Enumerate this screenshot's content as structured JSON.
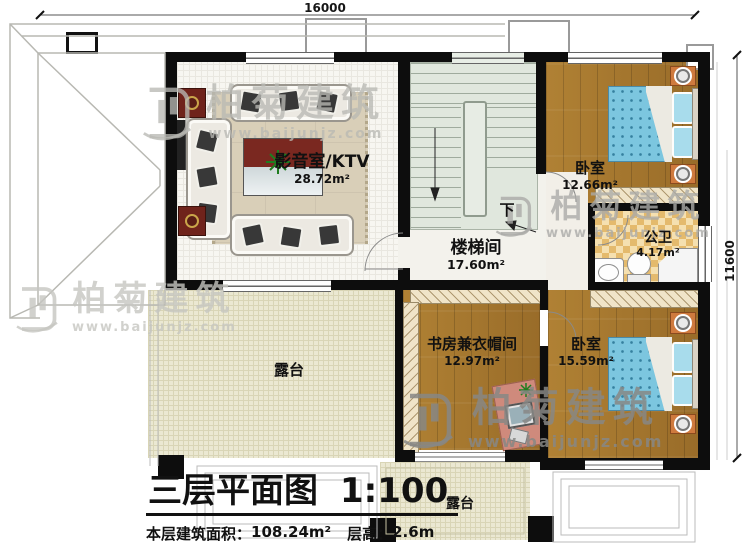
{
  "title_block": {
    "name": "三层平面图",
    "scale": "1:100",
    "area_label": "本层建筑面积：",
    "area_value": "108.24m²",
    "height_label": "层高：",
    "height_value": "2.6m"
  },
  "dimensions": {
    "top_width": "16000",
    "right_height": "11600"
  },
  "rooms": {
    "ktv": {
      "name": "影音室/KTV",
      "area": "28.72m²"
    },
    "stair_hall": {
      "name": "楼梯间",
      "area": "17.60m²"
    },
    "bedroom_top": {
      "name": "卧室",
      "area": "12.66m²"
    },
    "bathroom": {
      "name": "公卫",
      "area": "4.17m²"
    },
    "study_cloak": {
      "name": "书房兼衣帽间",
      "area": "12.97m²"
    },
    "bedroom_bottom": {
      "name": "卧室",
      "area": "15.59m²"
    },
    "terrace_left": {
      "name": "露台"
    },
    "terrace_bottom": {
      "name": "露台"
    }
  },
  "stairs": {
    "down_label": "下"
  },
  "watermark": {
    "brand": "柏菊建筑",
    "url": "www.baijunjz.com"
  },
  "colors": {
    "wall": "#0d0d0d",
    "wood_floor": "#a9772f",
    "bed_blue": "#7cc6df",
    "stair_green": "#e0e7dd",
    "terrace_beige": "#ebe8d2",
    "bath_checker": "#e8c27a",
    "accent_red": "#7a2820",
    "nightstand_orange": "#cf7a3e"
  }
}
